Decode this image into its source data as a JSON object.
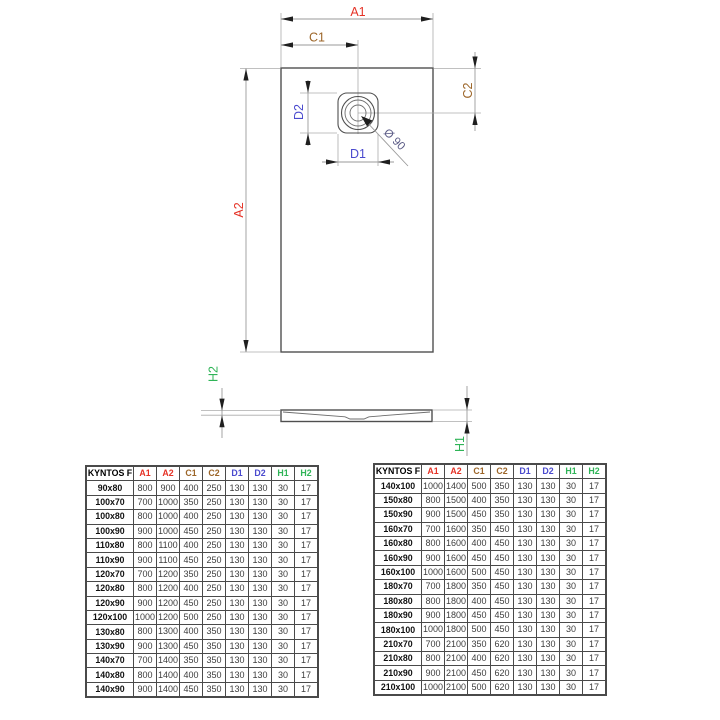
{
  "diagram": {
    "labels": {
      "a1": "A1",
      "a2": "A2",
      "c1": "C1",
      "c2": "C2",
      "d1": "D1",
      "d2": "D2",
      "h1": "H1",
      "h2": "H2",
      "diameter": "Ø 90"
    },
    "colors": {
      "a": "#e53226",
      "c": "#9c6528",
      "d": "#4a4ace",
      "h": "#2fb457",
      "diameter": "#5a5a85"
    }
  },
  "tables": [
    {
      "columns": [
        {
          "label": "KYNTOS F",
          "color": "#000000"
        },
        {
          "label": "A1",
          "color": "#e53226"
        },
        {
          "label": "A2",
          "color": "#e53226"
        },
        {
          "label": "C1",
          "color": "#9c6528"
        },
        {
          "label": "C2",
          "color": "#9c6528"
        },
        {
          "label": "D1",
          "color": "#4a4ace"
        },
        {
          "label": "D2",
          "color": "#4a4ace"
        },
        {
          "label": "H1",
          "color": "#2fb457"
        },
        {
          "label": "H2",
          "color": "#2fb457"
        }
      ],
      "rows": [
        [
          "90x80",
          800,
          900,
          400,
          250,
          130,
          130,
          30,
          17
        ],
        [
          "100x70",
          700,
          1000,
          350,
          250,
          130,
          130,
          30,
          17
        ],
        [
          "100x80",
          800,
          1000,
          400,
          250,
          130,
          130,
          30,
          17
        ],
        [
          "100x90",
          900,
          1000,
          450,
          250,
          130,
          130,
          30,
          17
        ],
        [
          "110x80",
          800,
          1100,
          400,
          250,
          130,
          130,
          30,
          17
        ],
        [
          "110x90",
          900,
          1100,
          450,
          250,
          130,
          130,
          30,
          17
        ],
        [
          "120x70",
          700,
          1200,
          350,
          250,
          130,
          130,
          30,
          17
        ],
        [
          "120x80",
          800,
          1200,
          400,
          250,
          130,
          130,
          30,
          17
        ],
        [
          "120x90",
          900,
          1200,
          450,
          250,
          130,
          130,
          30,
          17
        ],
        [
          "120x100",
          1000,
          1200,
          500,
          250,
          130,
          130,
          30,
          17
        ],
        [
          "130x80",
          800,
          1300,
          400,
          350,
          130,
          130,
          30,
          17
        ],
        [
          "130x90",
          900,
          1300,
          450,
          350,
          130,
          130,
          30,
          17
        ],
        [
          "140x70",
          700,
          1400,
          350,
          350,
          130,
          130,
          30,
          17
        ],
        [
          "140x80",
          800,
          1400,
          400,
          350,
          130,
          130,
          30,
          17
        ],
        [
          "140x90",
          900,
          1400,
          450,
          350,
          130,
          130,
          30,
          17
        ]
      ]
    },
    {
      "columns": [
        {
          "label": "KYNTOS F",
          "color": "#000000"
        },
        {
          "label": "A1",
          "color": "#e53226"
        },
        {
          "label": "A2",
          "color": "#e53226"
        },
        {
          "label": "C1",
          "color": "#9c6528"
        },
        {
          "label": "C2",
          "color": "#9c6528"
        },
        {
          "label": "D1",
          "color": "#4a4ace"
        },
        {
          "label": "D2",
          "color": "#4a4ace"
        },
        {
          "label": "H1",
          "color": "#2fb457"
        },
        {
          "label": "H2",
          "color": "#2fb457"
        }
      ],
      "rows": [
        [
          "140x100",
          1000,
          1400,
          500,
          350,
          130,
          130,
          30,
          17
        ],
        [
          "150x80",
          800,
          1500,
          400,
          350,
          130,
          130,
          30,
          17
        ],
        [
          "150x90",
          900,
          1500,
          450,
          350,
          130,
          130,
          30,
          17
        ],
        [
          "160x70",
          700,
          1600,
          350,
          450,
          130,
          130,
          30,
          17
        ],
        [
          "160x80",
          800,
          1600,
          400,
          450,
          130,
          130,
          30,
          17
        ],
        [
          "160x90",
          900,
          1600,
          450,
          450,
          130,
          130,
          30,
          17
        ],
        [
          "160x100",
          1000,
          1600,
          500,
          450,
          130,
          130,
          30,
          17
        ],
        [
          "180x70",
          700,
          1800,
          350,
          450,
          130,
          130,
          30,
          17
        ],
        [
          "180x80",
          800,
          1800,
          400,
          450,
          130,
          130,
          30,
          17
        ],
        [
          "180x90",
          900,
          1800,
          450,
          450,
          130,
          130,
          30,
          17
        ],
        [
          "180x100",
          1000,
          1800,
          500,
          450,
          130,
          130,
          30,
          17
        ],
        [
          "210x70",
          700,
          2100,
          350,
          620,
          130,
          130,
          30,
          17
        ],
        [
          "210x80",
          800,
          2100,
          400,
          620,
          130,
          130,
          30,
          17
        ],
        [
          "210x90",
          900,
          2100,
          450,
          620,
          130,
          130,
          30,
          17
        ],
        [
          "210x100",
          1000,
          2100,
          500,
          620,
          130,
          130,
          30,
          17
        ]
      ]
    }
  ]
}
